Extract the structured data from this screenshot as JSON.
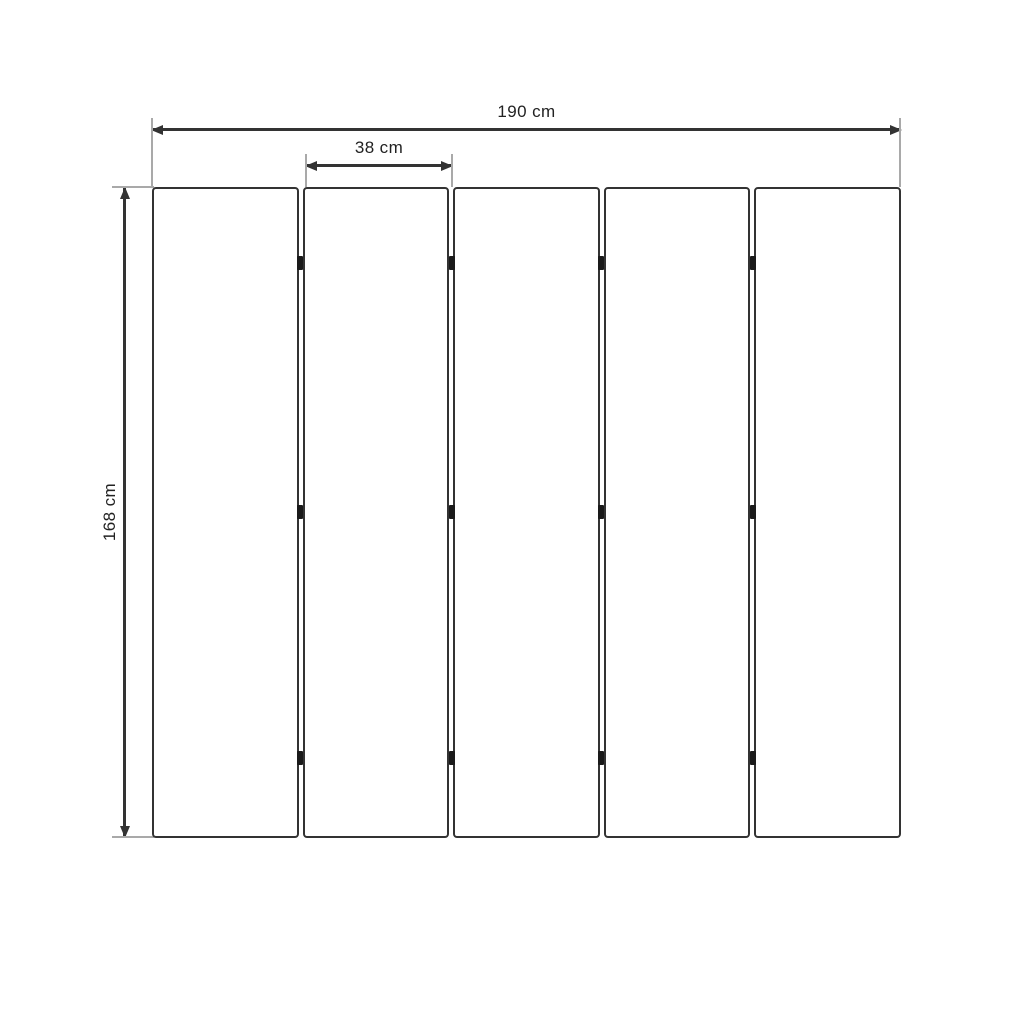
{
  "diagram": {
    "kind": "dimension-drawing",
    "dimensions": {
      "total_width": "190 cm",
      "single_panel_width": "38 cm",
      "height": "168 cm"
    },
    "panel_count": 5,
    "hinge_rows_pct": [
      11.7,
      49.9,
      87.7
    ],
    "hinge_junctions_pct": [
      19.8,
      40,
      60,
      80.2
    ],
    "colors": {
      "line_dark": "#333333",
      "extension_gray": "#a9a9a9",
      "hinge_black": "#1a1a1a",
      "text": "#222222",
      "background": "#ffffff"
    }
  }
}
